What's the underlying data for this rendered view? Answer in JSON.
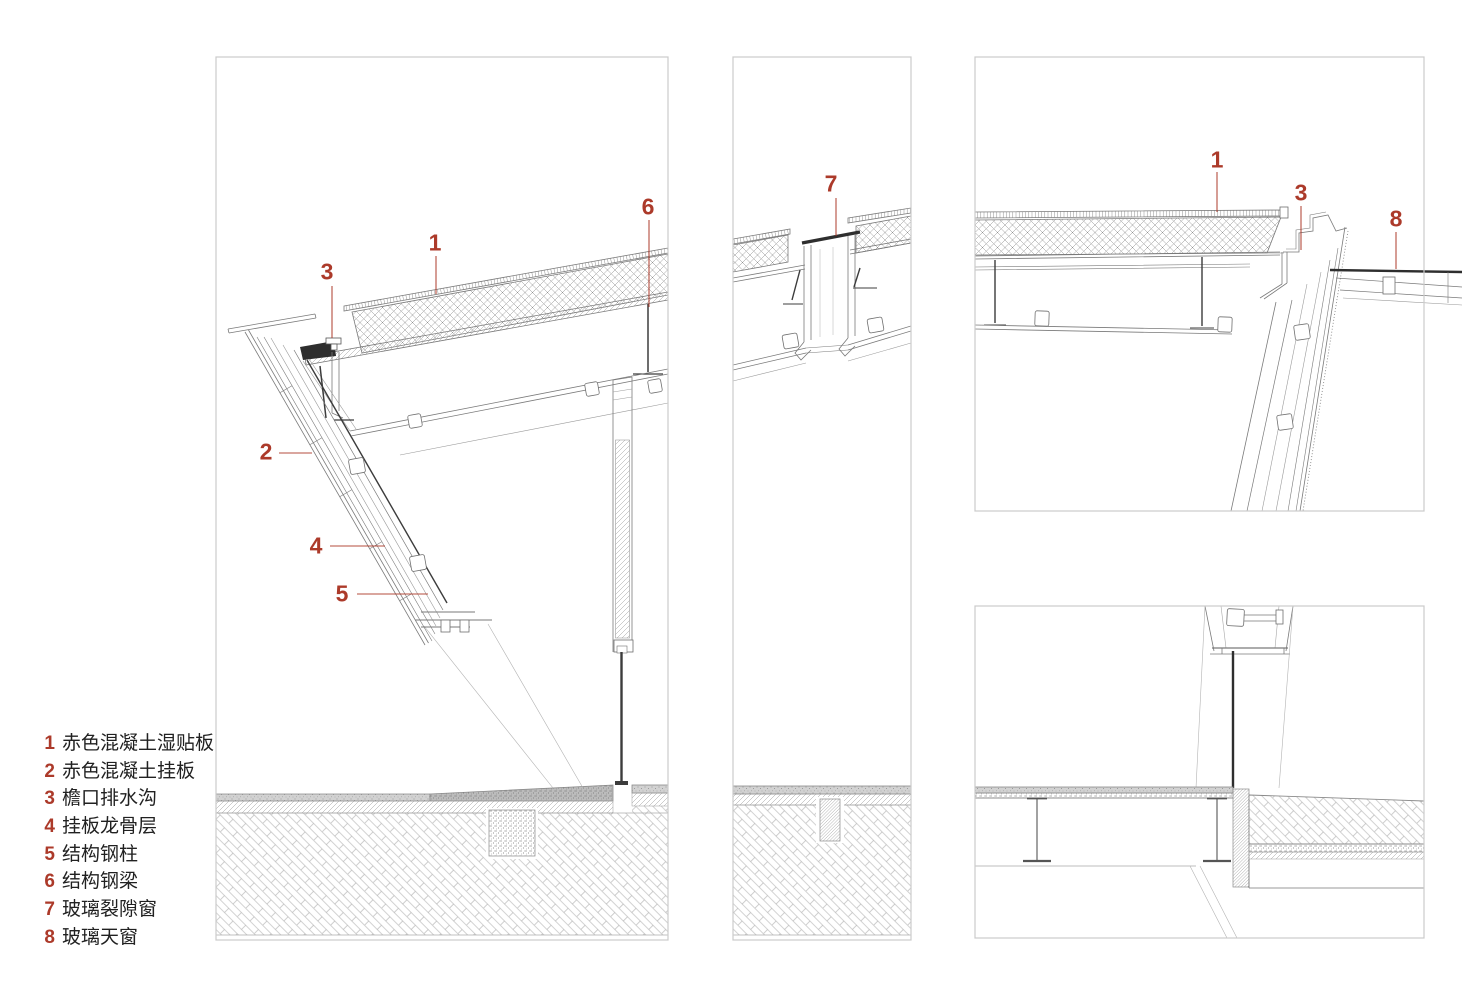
{
  "palette": {
    "accent_red": "#ac3a2a",
    "line_gray": "#7a7a7a",
    "line_light": "#a8a8a8",
    "dark_detail": "#2e2e2e",
    "panel_border": "#cbcbcb",
    "background": "#ffffff"
  },
  "legend": {
    "items": [
      {
        "num": "1",
        "label": "赤色混凝土湿贴板"
      },
      {
        "num": "2",
        "label": "赤色混凝土挂板"
      },
      {
        "num": "3",
        "label": "檐口排水沟"
      },
      {
        "num": "4",
        "label": "挂板龙骨层"
      },
      {
        "num": "5",
        "label": "结构钢柱"
      },
      {
        "num": "6",
        "label": "结构钢梁"
      },
      {
        "num": "7",
        "label": "玻璃裂隙窗"
      },
      {
        "num": "8",
        "label": "玻璃天窗"
      }
    ]
  },
  "callouts": {
    "left_panel": [
      {
        "num": "3"
      },
      {
        "num": "1"
      },
      {
        "num": "6"
      },
      {
        "num": "2"
      },
      {
        "num": "4"
      },
      {
        "num": "5"
      }
    ],
    "middle_panel": [
      {
        "num": "7"
      }
    ],
    "top_right_panel": [
      {
        "num": "1"
      },
      {
        "num": "3"
      },
      {
        "num": "8"
      }
    ]
  }
}
